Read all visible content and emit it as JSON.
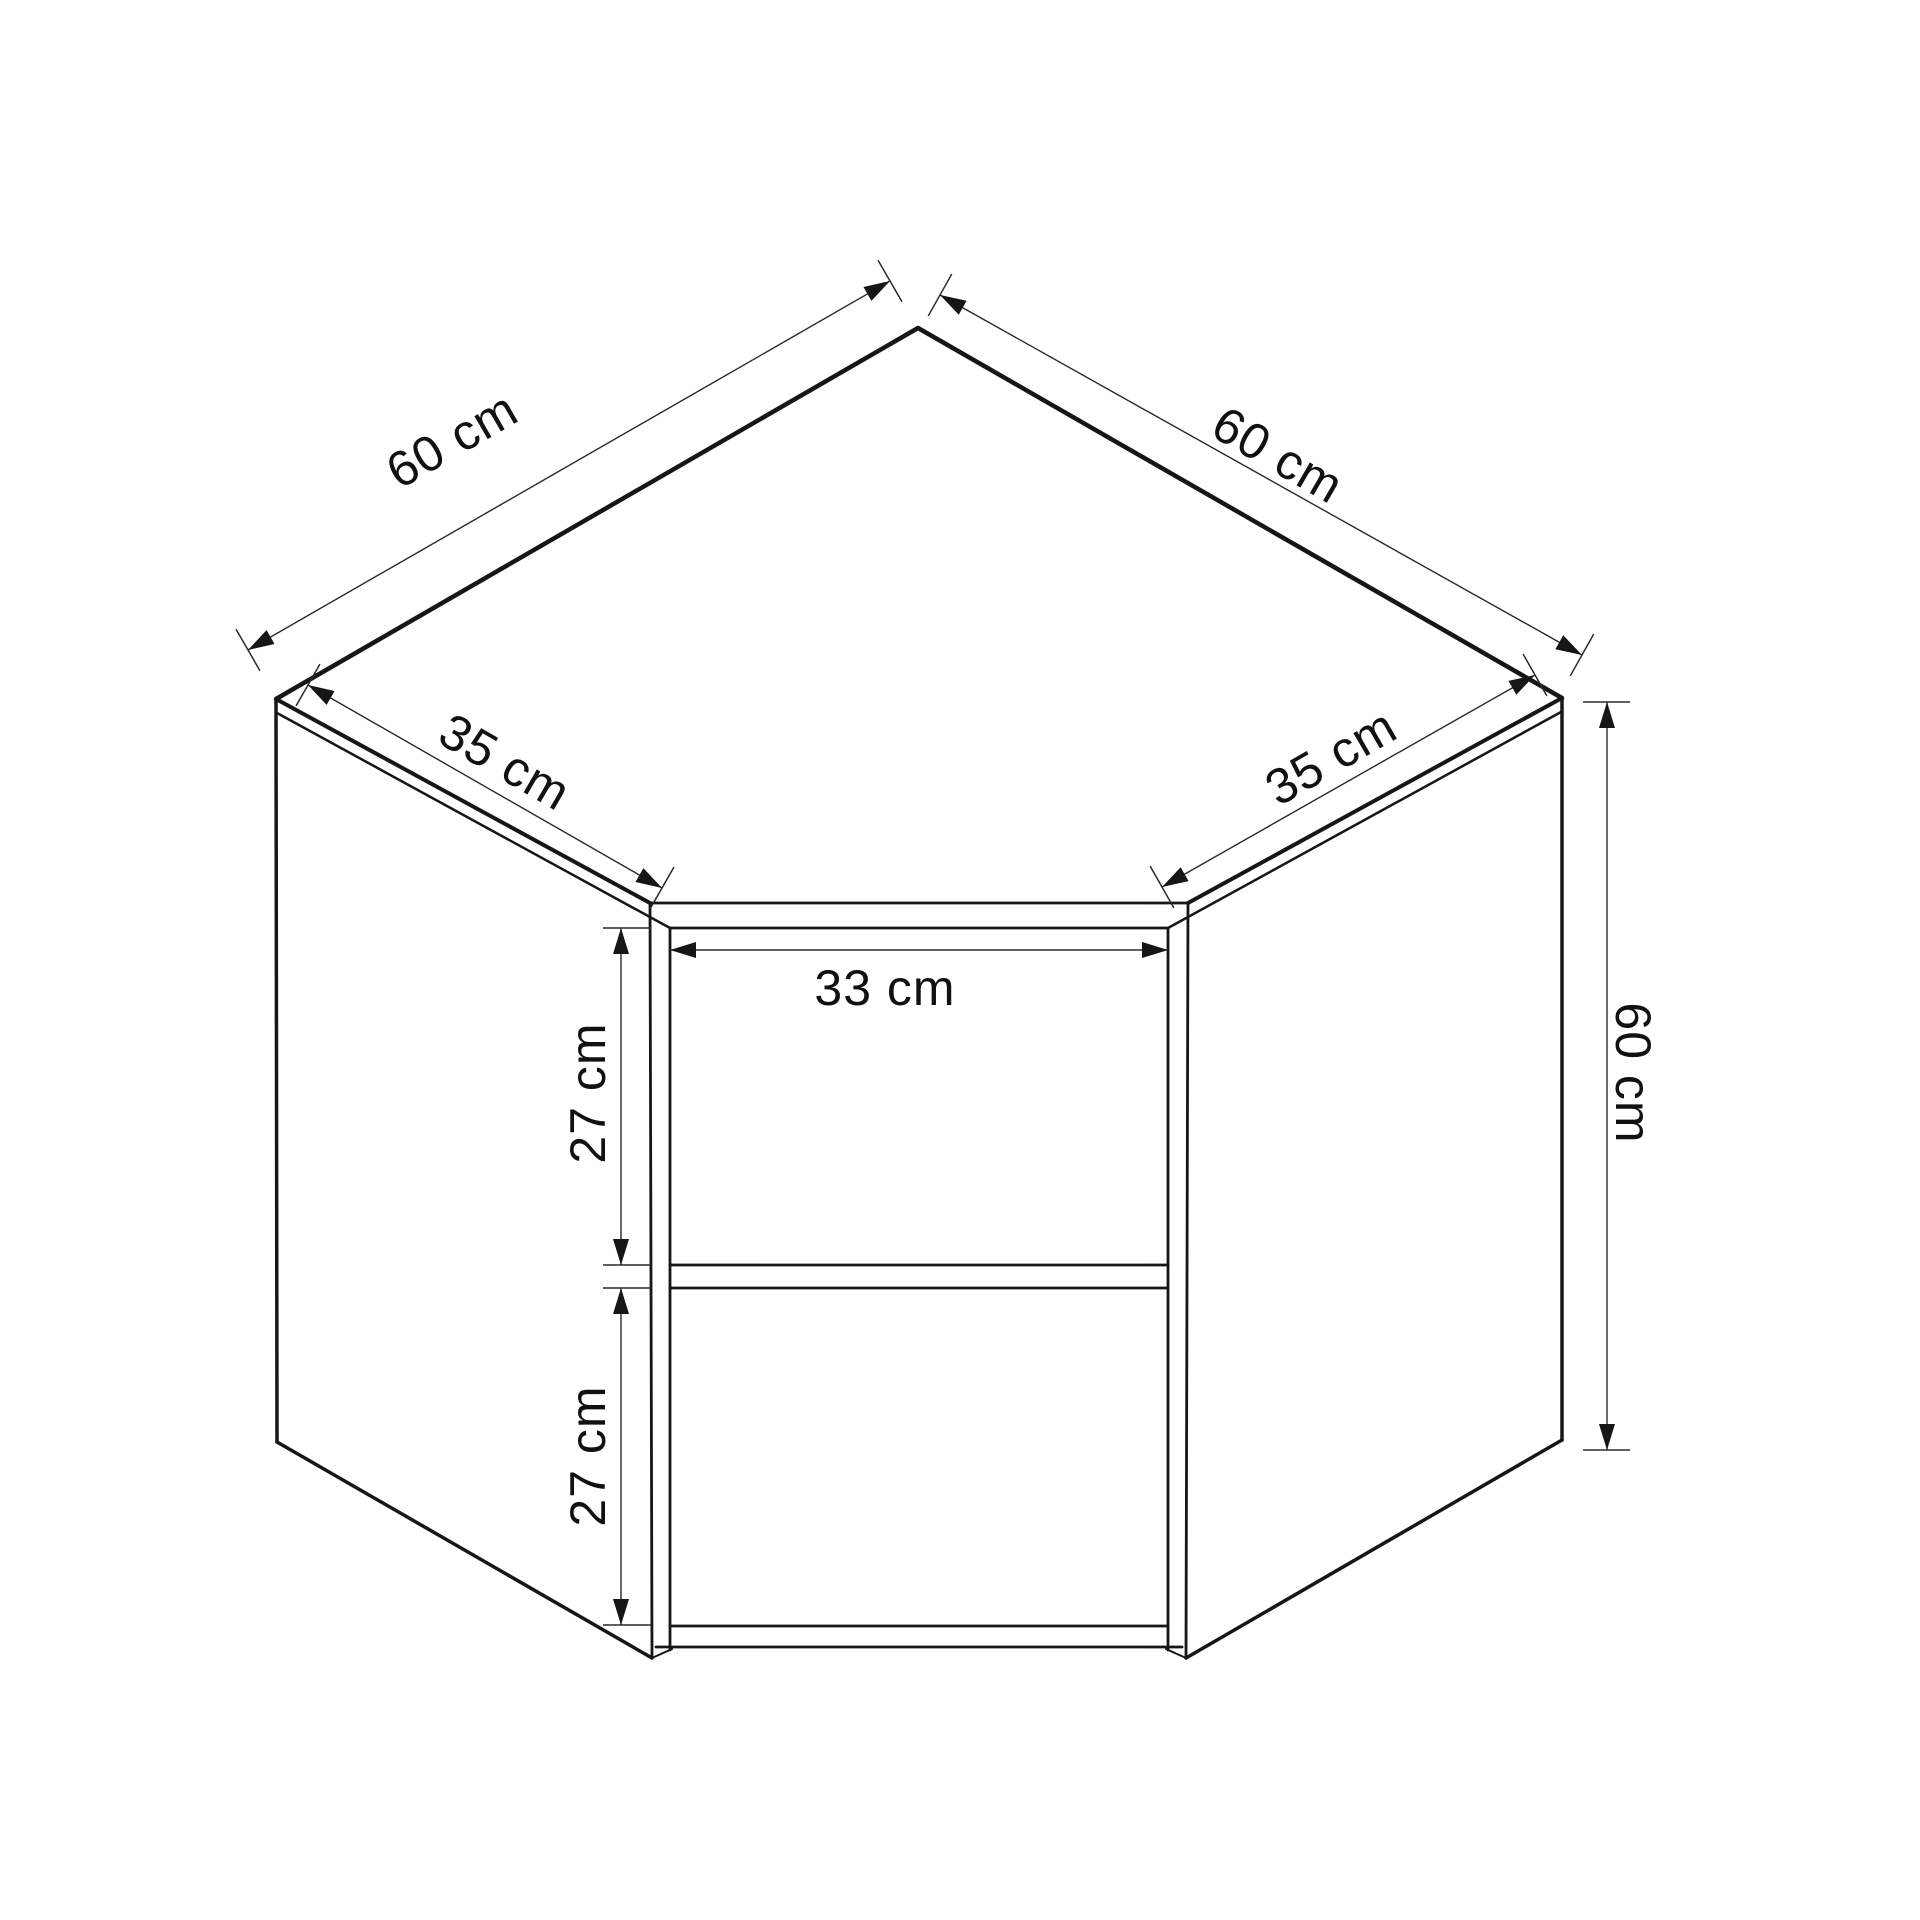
{
  "diagram": {
    "type": "technical-drawing",
    "subject": "corner wall cabinet with shelf, dimensioned view",
    "background_color": "#ffffff",
    "line_color": "#161616",
    "text_color": "#111111",
    "unit": "cm",
    "dimensions": [
      {
        "id": "top-left-width",
        "label": "60 cm",
        "value": 60,
        "unit": "cm"
      },
      {
        "id": "top-right-width",
        "label": "60 cm",
        "value": 60,
        "unit": "cm"
      },
      {
        "id": "left-front-depth",
        "label": "35 cm",
        "value": 35,
        "unit": "cm"
      },
      {
        "id": "right-front-depth",
        "label": "35 cm",
        "value": 35,
        "unit": "cm"
      },
      {
        "id": "opening-width",
        "label": "33 cm",
        "value": 33,
        "unit": "cm"
      },
      {
        "id": "upper-compartment-height",
        "label": "27 cm",
        "value": 27,
        "unit": "cm"
      },
      {
        "id": "lower-compartment-height",
        "label": "27 cm",
        "value": 27,
        "unit": "cm"
      },
      {
        "id": "side-height",
        "label": "60 cm",
        "value": 60,
        "unit": "cm"
      }
    ]
  }
}
